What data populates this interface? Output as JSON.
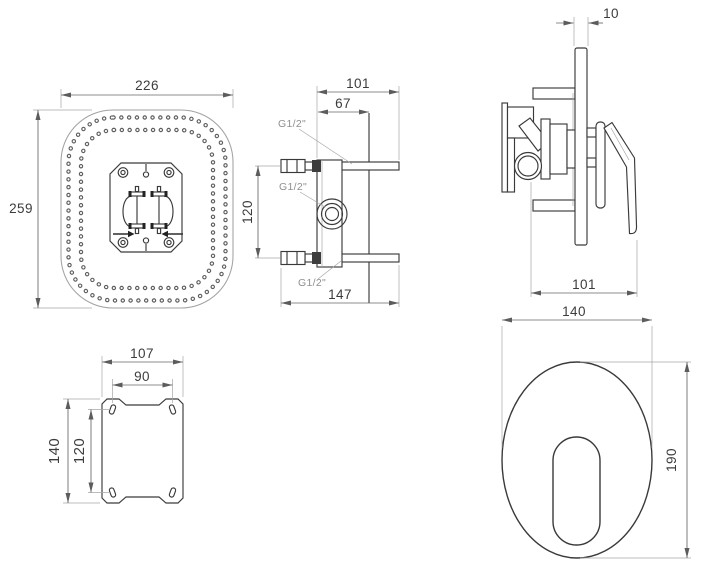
{
  "drawing": {
    "background": "#ffffff",
    "line_color": "#3a3a3a",
    "dim_line_color": "#676767",
    "dim_text_color": "#3c3c3c",
    "port_label_color": "#8f8f8f",
    "views": {
      "shower_head_front": {
        "dim_width": "226",
        "dim_height": "259"
      },
      "valve_rough_in_side": {
        "dim_total_depth": "101",
        "dim_front_depth": "67",
        "dim_port_spacing": "120",
        "dim_overall_depth": "147",
        "port_label_top": "G1/2\"",
        "port_label_middle": "G1/2\"",
        "port_label_bottom": "G1/2\""
      },
      "mixer_trim_side": {
        "dim_plate_thickness": "10",
        "dim_depth": "101"
      },
      "mounting_bracket_front": {
        "dim_width": "107",
        "dim_hole_spacing_width": "90",
        "dim_height": "140",
        "dim_hole_spacing_height": "120"
      },
      "trim_plate_front": {
        "dim_width": "140",
        "dim_height": "190"
      }
    }
  }
}
